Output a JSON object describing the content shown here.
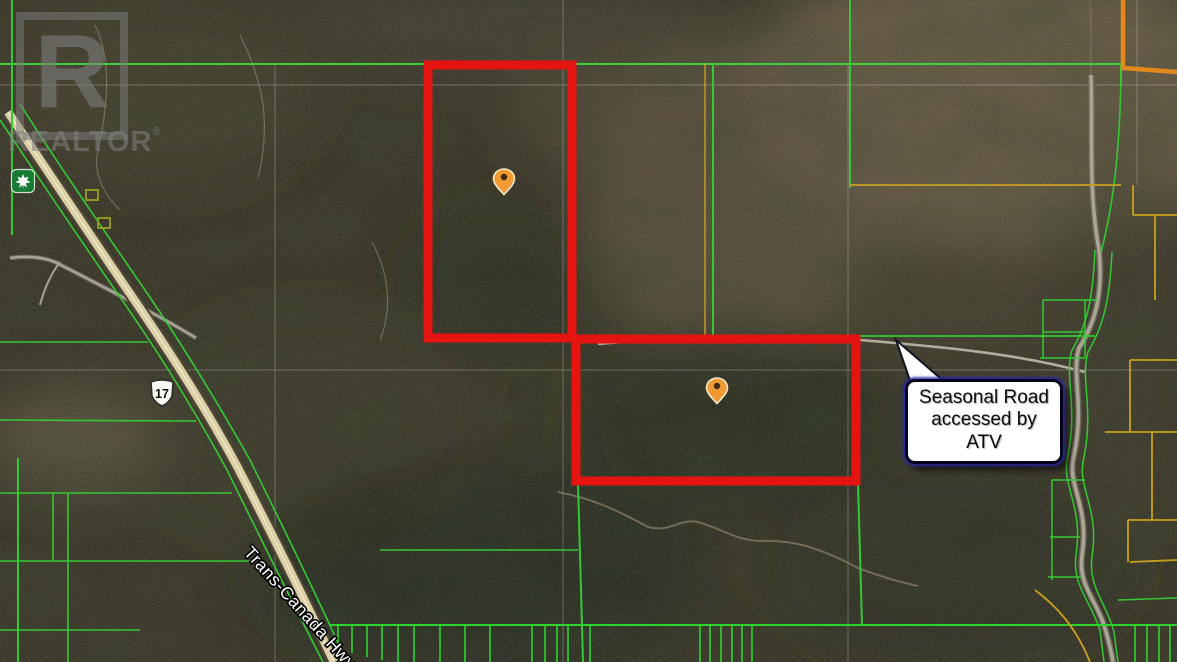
{
  "watermark": {
    "letter": "R",
    "name": "REALTOR",
    "reg": "®"
  },
  "roads": {
    "highway_label": "Trans-Canada Hwy",
    "shield_number": "17",
    "shield_name": "highway-17-shield",
    "trans_canada_marker": "maple-leaf-shield"
  },
  "callout": {
    "line1": "Seasonal Road",
    "line2": "accessed by",
    "line3": "ATV"
  },
  "markers": [
    {
      "id": "property-pin-north"
    },
    {
      "id": "property-pin-south"
    }
  ],
  "parcels": [
    {
      "id": "north-parcel-boundary"
    },
    {
      "id": "south-parcel-boundary"
    }
  ],
  "colors": {
    "parcel_boundary_red": "#e61410",
    "cadastral_green": "#35c835",
    "cadastral_yellow": "#c8a020",
    "cadastral_orange": "#e2891e",
    "marker_orange": "#ef9a33",
    "highway_fill": "#dbcfa6",
    "road_gray": "#a8a296",
    "callout_border_blue": "#05051e",
    "callout_bg": "#ffffff"
  }
}
